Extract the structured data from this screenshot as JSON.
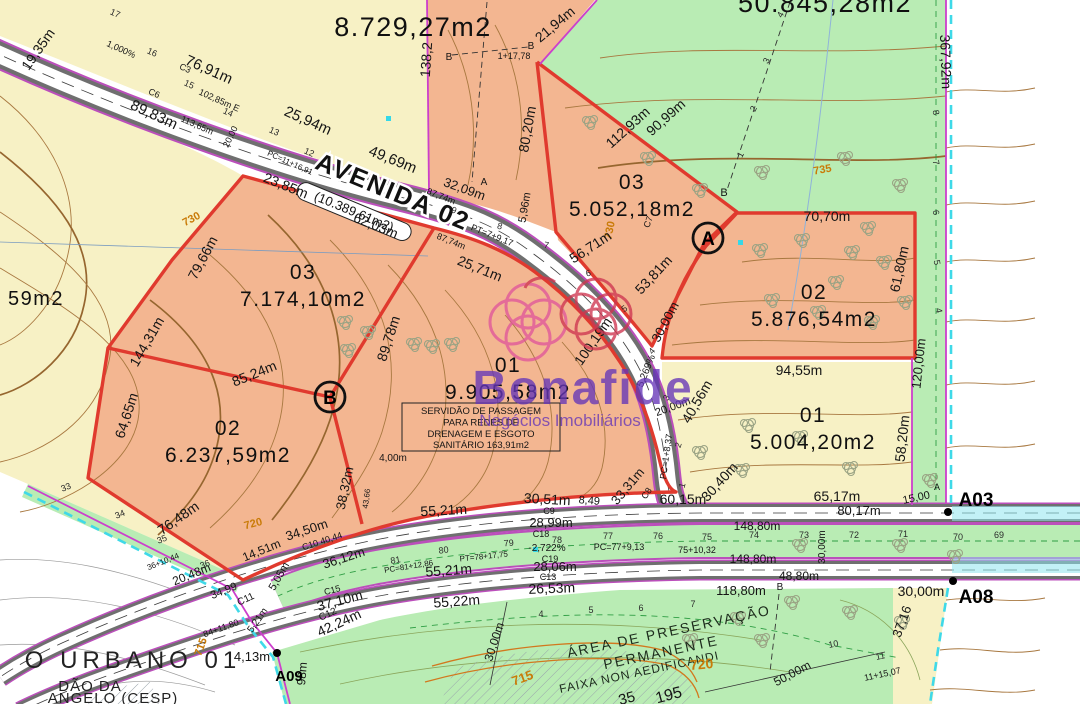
{
  "watermark": {
    "brand": "Bonafide",
    "tagline": "Negócios Imobiliários"
  },
  "road": {
    "name": "AVENIDA 02",
    "area_note": "(10.389,61m2)"
  },
  "easement": {
    "lines": [
      "SERVIDÃO DE PASSAGEM",
      "PARA REDES DE",
      "DRENAGEM E ESGOTO",
      "SANITÁRIO 163,91m2"
    ]
  },
  "markers": {
    "circled": [
      "A",
      "B"
    ]
  },
  "colors": {
    "lot_fill": "#f3b691",
    "lot_border": "#e03a2e",
    "yellow": "#f7f1c5",
    "green": "#b9ecb4",
    "road_edge": "#bb4fbb",
    "boundary_magenta": "#cc3fcc",
    "boundary_cyan": "#3fd9e8",
    "contour": "#a87840",
    "contour_label": "#c97b08",
    "watermark_purple": "#6636b8"
  },
  "lots": [
    {
      "number": "03",
      "area": "7.174,10m2",
      "x": 303,
      "y": 279
    },
    {
      "number": "02",
      "area": "6.237,59m2",
      "x": 228,
      "y": 435
    },
    {
      "number": "01",
      "area": "9.905,58m2",
      "x": 508,
      "y": 372
    },
    {
      "number": "03",
      "area": "5.052,18m2",
      "x": 632,
      "y": 189
    },
    {
      "number": "02",
      "area": "5.876,54m2",
      "x": 814,
      "y": 299
    },
    {
      "number": "01",
      "area": "5.004,20m2",
      "x": 813,
      "y": 422
    }
  ],
  "map_labels": [
    {
      "t": "19,35m",
      "x": 42,
      "y": 52,
      "r": -55,
      "s": 14
    },
    {
      "t": "1,000%",
      "x": 120,
      "y": 52,
      "r": 24,
      "s": 9
    },
    {
      "t": "76,91m",
      "x": 207,
      "y": 74,
      "r": 24,
      "s": 15
    },
    {
      "t": "C3",
      "x": 184,
      "y": 71,
      "r": 24,
      "s": 9
    },
    {
      "t": "102,85m E",
      "x": 218,
      "y": 103,
      "r": 24,
      "s": 9
    },
    {
      "t": "C6",
      "x": 153,
      "y": 96,
      "r": 24,
      "s": 9
    },
    {
      "t": "113,65m",
      "x": 196,
      "y": 128,
      "r": 24,
      "s": 9
    },
    {
      "t": "89,83m",
      "x": 152,
      "y": 119,
      "r": 25,
      "s": 15
    },
    {
      "t": "25,94m",
      "x": 306,
      "y": 125,
      "r": 24,
      "s": 15
    },
    {
      "t": "20,00",
      "x": 233,
      "y": 138,
      "r": -64,
      "s": 9
    },
    {
      "t": "49,69m",
      "x": 391,
      "y": 164,
      "r": 22,
      "s": 15
    },
    {
      "t": "PC=11+16,91",
      "x": 289,
      "y": 165,
      "r": 24,
      "s": 8
    },
    {
      "t": "17",
      "x": 114,
      "y": 16,
      "r": 24,
      "s": 9,
      "c": "st"
    },
    {
      "t": "16",
      "x": 151,
      "y": 55,
      "r": 24,
      "s": 9,
      "c": "st"
    },
    {
      "t": "15",
      "x": 188,
      "y": 87,
      "r": 24,
      "s": 9,
      "c": "st"
    },
    {
      "t": "14",
      "x": 227,
      "y": 115,
      "r": 24,
      "s": 9,
      "c": "st"
    },
    {
      "t": "13",
      "x": 273,
      "y": 134,
      "r": 24,
      "s": 9,
      "c": "st"
    },
    {
      "t": "12",
      "x": 308,
      "y": 155,
      "r": 24,
      "s": 9,
      "c": "st"
    },
    {
      "t": "8.729,27m2",
      "x": 413,
      "y": 36,
      "s": 27,
      "c": "big"
    },
    {
      "t": "50.845,28m2",
      "x": 825,
      "y": 12,
      "s": 27,
      "c": "big"
    },
    {
      "t": "138,2",
      "x": 431,
      "y": 60,
      "r": -86,
      "s": 14
    },
    {
      "t": "23,85m",
      "x": 284,
      "y": 190,
      "r": 22,
      "s": 14
    },
    {
      "t": "87,74m",
      "x": 440,
      "y": 199,
      "r": 22,
      "s": 9
    },
    {
      "t": "87,74m",
      "x": 450,
      "y": 244,
      "r": 22,
      "s": 9
    },
    {
      "t": "62,03m",
      "x": 374,
      "y": 230,
      "r": 22,
      "s": 14
    },
    {
      "t": "32,09m",
      "x": 463,
      "y": 193,
      "r": 20,
      "s": 13
    },
    {
      "t": "A",
      "x": 484,
      "y": 185,
      "s": 10
    },
    {
      "t": "B",
      "x": 531,
      "y": 49,
      "s": 10
    },
    {
      "t": "B",
      "x": 449,
      "y": 60,
      "s": 10
    },
    {
      "t": "1+17,78",
      "x": 514,
      "y": 59,
      "s": 9
    },
    {
      "t": "21,94m",
      "x": 558,
      "y": 28,
      "r": -40,
      "s": 14
    },
    {
      "t": "4",
      "x": 783,
      "y": 16,
      "r": -62,
      "s": 9,
      "c": "st"
    },
    {
      "t": "3",
      "x": 769,
      "y": 62,
      "r": -62,
      "s": 9,
      "c": "st"
    },
    {
      "t": "2",
      "x": 756,
      "y": 110,
      "r": -62,
      "s": 9,
      "c": "st"
    },
    {
      "t": "1",
      "x": 743,
      "y": 156,
      "r": -62,
      "s": 9,
      "c": "st"
    },
    {
      "t": "B",
      "x": 724,
      "y": 196,
      "s": 11
    },
    {
      "t": "5,96m",
      "x": 528,
      "y": 208,
      "r": -80,
      "s": 11
    },
    {
      "t": "80,20m",
      "x": 532,
      "y": 130,
      "r": -80,
      "s": 14
    },
    {
      "t": "112,93m",
      "x": 631,
      "y": 131,
      "r": -42,
      "s": 14
    },
    {
      "t": "90,99m",
      "x": 669,
      "y": 121,
      "r": -42,
      "s": 14
    },
    {
      "t": "367,92m",
      "x": 941,
      "y": 62,
      "r": 88,
      "s": 14
    },
    {
      "t": "8",
      "x": 933,
      "y": 113,
      "r": 80,
      "s": 9,
      "c": "st"
    },
    {
      "t": "7",
      "x": 933,
      "y": 163,
      "r": 80,
      "s": 9,
      "c": "st"
    },
    {
      "t": "6",
      "x": 933,
      "y": 213,
      "r": 80,
      "s": 9,
      "c": "st"
    },
    {
      "t": "5",
      "x": 934,
      "y": 263,
      "r": 80,
      "s": 9,
      "c": "st"
    },
    {
      "t": "4",
      "x": 936,
      "y": 311,
      "r": 80,
      "s": 9,
      "c": "st"
    },
    {
      "t": "735",
      "x": 823,
      "y": 173,
      "r": -10,
      "s": 11,
      "c": "contour"
    },
    {
      "t": "730",
      "x": 193,
      "y": 222,
      "r": -28,
      "s": 11,
      "c": "contour"
    },
    {
      "t": "730",
      "x": 613,
      "y": 231,
      "r": -78,
      "s": 11,
      "c": "contour"
    },
    {
      "t": "79,66m",
      "x": 207,
      "y": 260,
      "r": -62,
      "s": 14
    },
    {
      "t": "25,71m",
      "x": 478,
      "y": 273,
      "r": 22,
      "s": 14
    },
    {
      "t": "PT=7+9,17",
      "x": 491,
      "y": 238,
      "r": 22,
      "s": 9
    },
    {
      "t": "56,71m",
      "x": 593,
      "y": 251,
      "r": -33,
      "s": 14
    },
    {
      "t": "53,81m",
      "x": 657,
      "y": 278,
      "r": -47,
      "s": 14
    },
    {
      "t": "C7",
      "x": 651,
      "y": 223,
      "r": -70,
      "s": 9
    },
    {
      "t": "30,00m",
      "x": 669,
      "y": 324,
      "r": -62,
      "s": 13
    },
    {
      "t": "9",
      "x": 453,
      "y": 213,
      "r": 20,
      "s": 9,
      "c": "st"
    },
    {
      "t": "8",
      "x": 499,
      "y": 229,
      "r": 15,
      "s": 9,
      "c": "st"
    },
    {
      "t": "7",
      "x": 546,
      "y": 248,
      "r": 10,
      "s": 9,
      "c": "st"
    },
    {
      "t": "6",
      "x": 589,
      "y": 276,
      "r": -15,
      "s": 9,
      "c": "st"
    },
    {
      "t": "5",
      "x": 626,
      "y": 311,
      "r": -35,
      "s": 9,
      "c": "st"
    },
    {
      "t": "4",
      "x": 654,
      "y": 353,
      "r": -48,
      "s": 9,
      "c": "st"
    },
    {
      "t": "3",
      "x": 669,
      "y": 399,
      "r": -62,
      "s": 9,
      "c": "st"
    },
    {
      "t": "2",
      "x": 681,
      "y": 446,
      "r": -72,
      "s": 9,
      "c": "st"
    },
    {
      "t": "1",
      "x": 685,
      "y": 486,
      "r": -76,
      "s": 9,
      "c": "st"
    },
    {
      "t": "5,269%",
      "x": 649,
      "y": 372,
      "r": -68,
      "s": 10
    },
    {
      "t": "20,00m",
      "x": 674,
      "y": 410,
      "r": -20,
      "s": 11
    },
    {
      "t": "PC=1+8,37",
      "x": 669,
      "y": 457,
      "r": -82,
      "s": 9
    },
    {
      "t": "70,70m",
      "x": 827,
      "y": 221,
      "s": 14
    },
    {
      "t": "61,80m",
      "x": 904,
      "y": 270,
      "r": -78,
      "s": 14
    },
    {
      "t": "94,55m",
      "x": 799,
      "y": 375,
      "s": 14
    },
    {
      "t": "120,00m",
      "x": 923,
      "y": 364,
      "r": -84,
      "s": 13
    },
    {
      "t": "58,20m",
      "x": 907,
      "y": 439,
      "r": -84,
      "s": 14
    },
    {
      "t": "40,56m",
      "x": 701,
      "y": 404,
      "r": -60,
      "s": 14
    },
    {
      "t": "30,40m",
      "x": 723,
      "y": 485,
      "r": -48,
      "s": 14
    },
    {
      "t": "100,19m",
      "x": 597,
      "y": 344,
      "r": -55,
      "s": 14
    },
    {
      "t": "89,78m",
      "x": 393,
      "y": 340,
      "r": -72,
      "s": 14
    },
    {
      "t": "144,31m",
      "x": 151,
      "y": 344,
      "r": -60,
      "s": 14
    },
    {
      "t": "85,24m",
      "x": 256,
      "y": 378,
      "r": -22,
      "s": 14
    },
    {
      "t": "64,65m",
      "x": 131,
      "y": 417,
      "r": -72,
      "s": 14
    },
    {
      "t": "4,00m",
      "x": 393,
      "y": 461,
      "s": 10
    },
    {
      "t": "38,32m",
      "x": 349,
      "y": 489,
      "r": -78,
      "s": 13
    },
    {
      "t": "43,66",
      "x": 369,
      "y": 499,
      "r": -82,
      "s": 8
    },
    {
      "t": "76,48m",
      "x": 181,
      "y": 522,
      "r": -35,
      "s": 14
    },
    {
      "t": "720",
      "x": 254,
      "y": 527,
      "r": -15,
      "s": 11,
      "c": "contour"
    },
    {
      "t": "34,50m",
      "x": 308,
      "y": 534,
      "r": -18,
      "s": 13
    },
    {
      "t": "14,51m",
      "x": 263,
      "y": 554,
      "r": -22,
      "s": 12
    },
    {
      "t": "20,48m",
      "x": 193,
      "y": 578,
      "r": -22,
      "s": 12
    },
    {
      "t": "34,99",
      "x": 225,
      "y": 594,
      "r": -22,
      "s": 11
    },
    {
      "t": "36+10,44",
      "x": 164,
      "y": 564,
      "r": -22,
      "s": 8
    },
    {
      "t": "33",
      "x": 67,
      "y": 490,
      "r": -22,
      "s": 9,
      "c": "st"
    },
    {
      "t": "34",
      "x": 121,
      "y": 517,
      "r": -22,
      "s": 9,
      "c": "st"
    },
    {
      "t": "35",
      "x": 163,
      "y": 542,
      "r": -22,
      "s": 9,
      "c": "st"
    },
    {
      "t": "36",
      "x": 206,
      "y": 567,
      "r": -22,
      "s": 9,
      "c": "st"
    },
    {
      "t": "5,05m",
      "x": 282,
      "y": 578,
      "r": -60,
      "s": 11
    },
    {
      "t": "36,12m",
      "x": 345,
      "y": 562,
      "r": -18,
      "s": 13
    },
    {
      "t": "C10 40,44",
      "x": 323,
      "y": 544,
      "r": -18,
      "s": 9
    },
    {
      "t": "C11",
      "x": 247,
      "y": 602,
      "r": -25,
      "s": 10
    },
    {
      "t": "C15",
      "x": 333,
      "y": 593,
      "r": -15,
      "s": 9
    },
    {
      "t": "37,10m",
      "x": 341,
      "y": 605,
      "r": -15,
      "s": 14
    },
    {
      "t": "C12",
      "x": 329,
      "y": 617,
      "r": -25,
      "s": 10
    },
    {
      "t": "42,24m",
      "x": 341,
      "y": 627,
      "r": -25,
      "s": 14
    },
    {
      "t": "30,51m",
      "x": 547,
      "y": 504,
      "r": 3,
      "s": 14
    },
    {
      "t": "8,49",
      "x": 589,
      "y": 504,
      "r": 5,
      "s": 11
    },
    {
      "t": "33,31m",
      "x": 631,
      "y": 489,
      "r": -50,
      "s": 13
    },
    {
      "t": "C8",
      "x": 649,
      "y": 495,
      "r": -55,
      "s": 9
    },
    {
      "t": "60,15m",
      "x": 683,
      "y": 504,
      "s": 14
    },
    {
      "t": "55,21m",
      "x": 444,
      "y": 515,
      "r": -3,
      "s": 14
    },
    {
      "t": "C9",
      "x": 549,
      "y": 514,
      "s": 9
    },
    {
      "t": "28,99m",
      "x": 551,
      "y": 527,
      "s": 13
    },
    {
      "t": "C18",
      "x": 541,
      "y": 537,
      "s": 9
    },
    {
      "t": "-2,722%",
      "x": 547,
      "y": 551,
      "s": 10
    },
    {
      "t": "PC=77+9,13",
      "x": 619,
      "y": 550,
      "s": 9
    },
    {
      "t": "75+10,32",
      "x": 697,
      "y": 553,
      "s": 9
    },
    {
      "t": "PT=78+17,75",
      "x": 484,
      "y": 559,
      "r": -6,
      "s": 8
    },
    {
      "t": "PC=81+12,86",
      "x": 409,
      "y": 569,
      "r": -9,
      "s": 8
    },
    {
      "t": "81",
      "x": 396,
      "y": 563,
      "r": -10,
      "s": 9,
      "c": "st"
    },
    {
      "t": "80",
      "x": 444,
      "y": 553,
      "r": -8,
      "s": 9,
      "c": "st"
    },
    {
      "t": "79",
      "x": 509,
      "y": 546,
      "r": -5,
      "s": 9,
      "c": "st"
    },
    {
      "t": "78",
      "x": 557,
      "y": 543,
      "s": 9,
      "c": "st"
    },
    {
      "t": "77",
      "x": 608,
      "y": 539,
      "s": 9,
      "c": "st"
    },
    {
      "t": "76",
      "x": 658,
      "y": 539,
      "s": 9,
      "c": "st"
    },
    {
      "t": "75",
      "x": 707,
      "y": 540,
      "s": 9,
      "c": "st"
    },
    {
      "t": "74",
      "x": 754,
      "y": 538,
      "s": 9,
      "c": "st"
    },
    {
      "t": "73",
      "x": 804,
      "y": 538,
      "s": 9,
      "c": "st"
    },
    {
      "t": "72",
      "x": 854,
      "y": 538,
      "s": 9,
      "c": "st"
    },
    {
      "t": "71",
      "x": 903,
      "y": 537,
      "s": 9,
      "c": "st"
    },
    {
      "t": "70",
      "x": 958,
      "y": 540,
      "s": 9,
      "c": "st"
    },
    {
      "t": "69",
      "x": 999,
      "y": 538,
      "s": 9,
      "c": "st"
    },
    {
      "t": "55,21m",
      "x": 449,
      "y": 575,
      "r": -4,
      "s": 14
    },
    {
      "t": "C19",
      "x": 550,
      "y": 562,
      "s": 9
    },
    {
      "t": "28,06m",
      "x": 555,
      "y": 571,
      "s": 13
    },
    {
      "t": "C13",
      "x": 548,
      "y": 580,
      "s": 9
    },
    {
      "t": "26,53m",
      "x": 552,
      "y": 593,
      "r": -2,
      "s": 14
    },
    {
      "t": "55,22m",
      "x": 457,
      "y": 606,
      "r": -4,
      "s": 14
    },
    {
      "t": "65,17m",
      "x": 837,
      "y": 501,
      "s": 14
    },
    {
      "t": "80,17m",
      "x": 859,
      "y": 515,
      "s": 13
    },
    {
      "t": "15,00",
      "x": 917,
      "y": 501,
      "r": -12,
      "s": 11
    },
    {
      "t": "A",
      "x": 937,
      "y": 490,
      "s": 9
    },
    {
      "t": "148,80m",
      "x": 757,
      "y": 530,
      "s": 12
    },
    {
      "t": "30,00m",
      "x": 825,
      "y": 547,
      "r": -90,
      "s": 10
    },
    {
      "t": "148,80m",
      "x": 753,
      "y": 563,
      "s": 12
    },
    {
      "t": "48,80m",
      "x": 799,
      "y": 580,
      "s": 12
    },
    {
      "t": "118,80m",
      "x": 741,
      "y": 595,
      "s": 13
    },
    {
      "t": "B",
      "x": 780,
      "y": 590,
      "s": 10
    },
    {
      "t": "30,00m",
      "x": 921,
      "y": 596,
      "s": 14
    },
    {
      "t": "37,16",
      "x": 906,
      "y": 623,
      "r": -70,
      "s": 13
    },
    {
      "t": "30,00m",
      "x": 498,
      "y": 643,
      "r": -72,
      "s": 12
    },
    {
      "t": "50,00m",
      "x": 794,
      "y": 677,
      "r": -28,
      "s": 12
    },
    {
      "t": "11+15,07",
      "x": 883,
      "y": 677,
      "r": -12,
      "s": 9
    },
    {
      "t": "11",
      "x": 881,
      "y": 659,
      "r": -12,
      "s": 9,
      "c": "st"
    },
    {
      "t": "10",
      "x": 834,
      "y": 647,
      "r": -12,
      "s": 9,
      "c": "st"
    },
    {
      "t": "4",
      "x": 541,
      "y": 617,
      "s": 9,
      "c": "st"
    },
    {
      "t": "5",
      "x": 591,
      "y": 613,
      "s": 9,
      "c": "st"
    },
    {
      "t": "6",
      "x": 641,
      "y": 611,
      "s": 9,
      "c": "st"
    },
    {
      "t": "7",
      "x": 693,
      "y": 607,
      "s": 9,
      "c": "st"
    },
    {
      "t": "ÁREA DE PRESERVAÇÃO",
      "x": 670,
      "y": 636,
      "r": -12,
      "s": 14,
      "c": "zone"
    },
    {
      "t": "PERMANENTE",
      "x": 662,
      "y": 657,
      "r": -12,
      "s": 14,
      "c": "zone"
    },
    {
      "t": "FAIXA NON AEDIFICANDI",
      "x": 640,
      "y": 676,
      "r": -12,
      "s": 12,
      "c": "zone2"
    },
    {
      "t": "720",
      "x": 702,
      "y": 669,
      "r": -5,
      "s": 14,
      "c": "contour"
    },
    {
      "t": "715",
      "x": 524,
      "y": 682,
      "r": -20,
      "s": 13,
      "c": "contour"
    },
    {
      "t": "715",
      "x": 204,
      "y": 648,
      "r": -70,
      "s": 11,
      "c": "contour"
    },
    {
      "t": "195",
      "x": 670,
      "y": 700,
      "r": -15,
      "s": 16
    },
    {
      "t": "35",
      "x": 628,
      "y": 703,
      "r": -15,
      "s": 15
    },
    {
      "t": "4,13m",
      "x": 252,
      "y": 661,
      "s": 13
    },
    {
      "t": "84+11,80",
      "x": 222,
      "y": 631,
      "r": -20,
      "s": 9
    },
    {
      "t": "5,21m",
      "x": 260,
      "y": 622,
      "r": -55,
      "s": 10
    },
    {
      "t": "98m",
      "x": 306,
      "y": 674,
      "r": -85,
      "s": 12
    },
    {
      "t": "A03",
      "x": 976,
      "y": 506,
      "s": 19,
      "c": "pt"
    },
    {
      "t": "A08",
      "x": 976,
      "y": 603,
      "s": 19,
      "c": "pt"
    },
    {
      "t": "A09",
      "x": 289,
      "y": 681,
      "s": 15,
      "c": "pt"
    },
    {
      "t": "O URBANO 01",
      "x": 133,
      "y": 668,
      "s": 24,
      "c": "urb"
    },
    {
      "t": "DÃO DA",
      "x": 90,
      "y": 691,
      "s": 15,
      "c": "urb2"
    },
    {
      "t": "ANGELO (CESP)",
      "x": 113,
      "y": 703,
      "s": 15,
      "c": "urb2"
    },
    {
      "t": "59m2",
      "x": 36,
      "y": 305,
      "s": 20,
      "c": "big"
    }
  ],
  "trees": [
    [
      590,
      122
    ],
    [
      648,
      158
    ],
    [
      700,
      190
    ],
    [
      762,
      172
    ],
    [
      845,
      158
    ],
    [
      900,
      185
    ],
    [
      868,
      228
    ],
    [
      760,
      250
    ],
    [
      802,
      240
    ],
    [
      852,
      252
    ],
    [
      884,
      262
    ],
    [
      836,
      282
    ],
    [
      772,
      300
    ],
    [
      818,
      312
    ],
    [
      872,
      322
    ],
    [
      905,
      302
    ],
    [
      748,
      425
    ],
    [
      800,
      437
    ],
    [
      850,
      468
    ],
    [
      742,
      470
    ],
    [
      700,
      452
    ],
    [
      345,
      322
    ],
    [
      368,
      332
    ],
    [
      348,
      350
    ],
    [
      414,
      344
    ],
    [
      432,
      346
    ],
    [
      452,
      344
    ],
    [
      800,
      545
    ],
    [
      900,
      545
    ],
    [
      955,
      556
    ],
    [
      930,
      480
    ],
    [
      738,
      618
    ],
    [
      792,
      602
    ],
    [
      850,
      612
    ],
    [
      902,
      622
    ],
    [
      690,
      640
    ],
    [
      762,
      640
    ]
  ]
}
